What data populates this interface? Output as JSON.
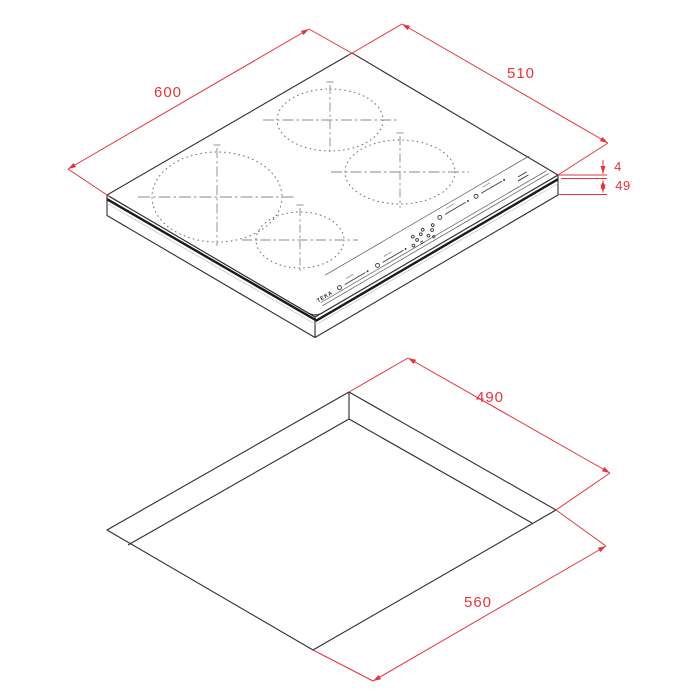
{
  "drawing": {
    "type": "technical-dimension-diagram",
    "colors": {
      "dimension_red": "#E5333C",
      "line_black": "#2e2e2e",
      "detail_gray": "#8a8a8a"
    },
    "top_figure": {
      "name": "induction-hob-isometric-view",
      "brand": "TEKA",
      "burner_count": 4,
      "dimensions": {
        "width_mm": {
          "value": "600"
        },
        "depth_mm": {
          "value": "510"
        },
        "glass_thickness_mm": {
          "value": "4"
        },
        "body_height_mm": {
          "value": "49"
        }
      }
    },
    "bottom_figure": {
      "name": "worktop-cutout-isometric-view",
      "dimensions": {
        "cutout_depth_mm": {
          "value": "490"
        },
        "cutout_width_mm": {
          "value": "560"
        }
      }
    }
  }
}
